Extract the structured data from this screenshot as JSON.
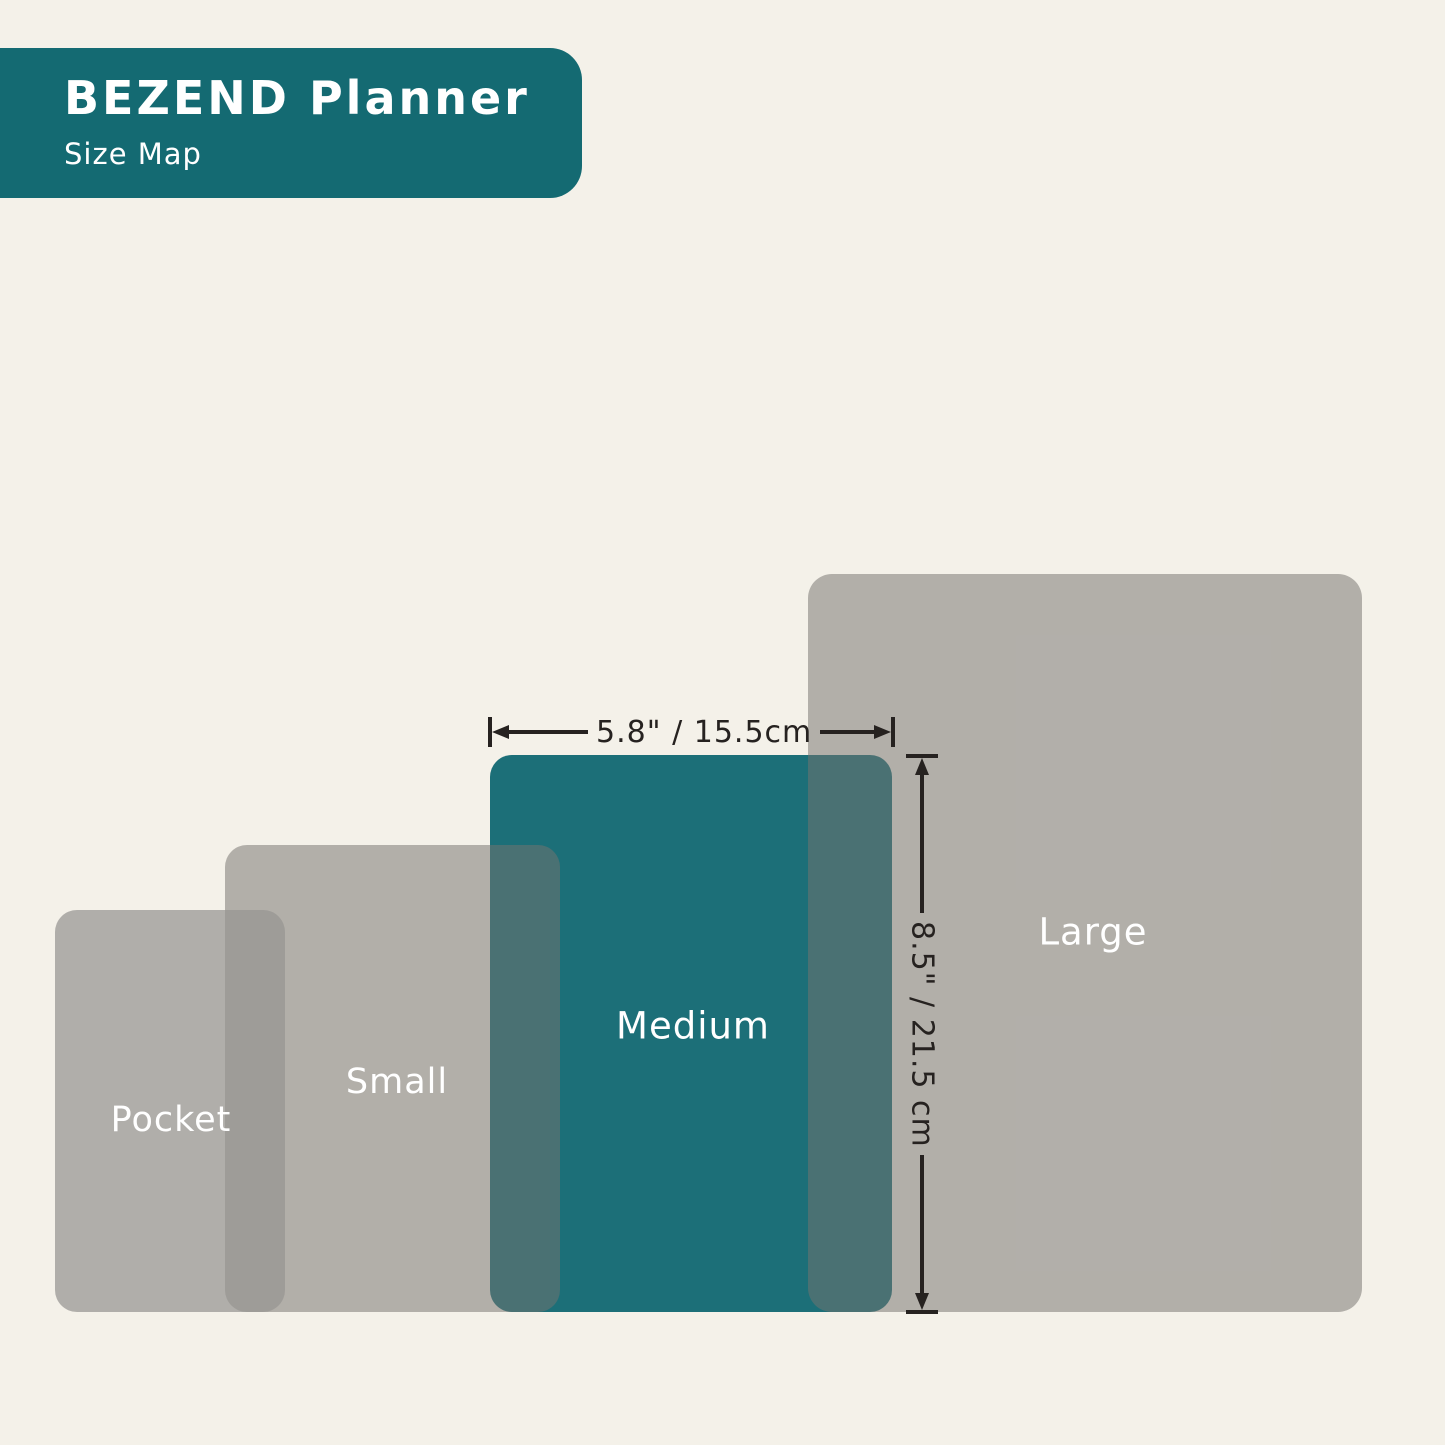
{
  "header": {
    "title": "BEZEND Planner",
    "subtitle": "Size Map"
  },
  "sizes": [
    {
      "id": "pocket",
      "label": "Pocket"
    },
    {
      "id": "small",
      "label": "Small"
    },
    {
      "id": "medium",
      "label": "Medium",
      "width": "5.8\" / 15.5cm",
      "height": "8.5\" / 21.5 cm"
    },
    {
      "id": "large",
      "label": "Large"
    }
  ],
  "colors": {
    "background": "#F4F1E9",
    "header_teal": "#146A72",
    "medium_teal": "#1C6F78",
    "overlay_gray": "rgba(117,115,112,0.52)",
    "pocket_gray": "rgba(150,148,145,0.72)",
    "dimension_ink": "#262220",
    "label_text": "#FFFFFF"
  }
}
